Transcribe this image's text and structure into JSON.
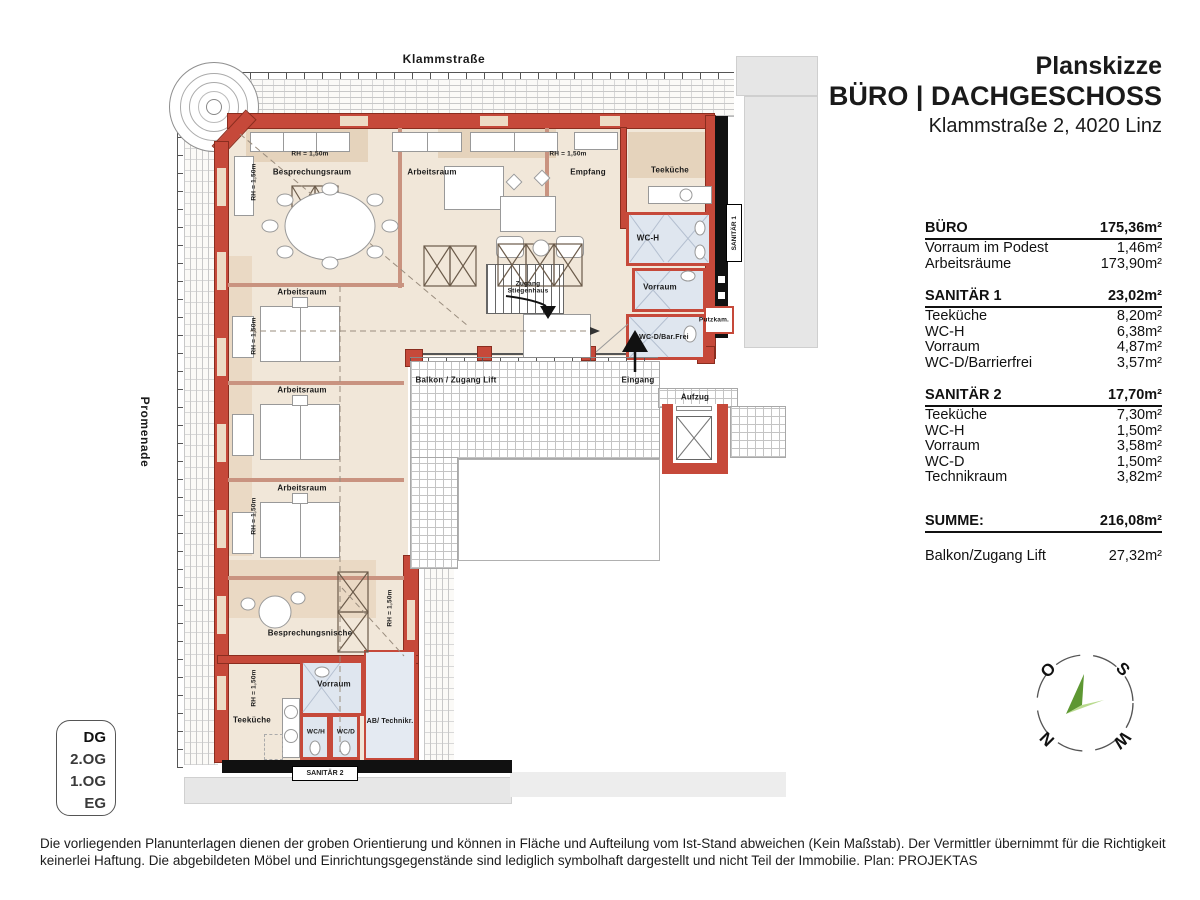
{
  "header": {
    "title": "Planskizze",
    "subtitle": "BÜRO | DACHGESCHOSS",
    "address": "Klammstraße 2, 4020 Linz"
  },
  "area_table": {
    "rows": [
      {
        "type": "header",
        "label": "BÜRO",
        "value": "175,36m²"
      },
      {
        "type": "item",
        "label": "Vorraum im Podest",
        "value": "1,46m²"
      },
      {
        "type": "item",
        "label": "Arbeitsräume",
        "value": "173,90m²"
      },
      {
        "type": "gap"
      },
      {
        "type": "header",
        "label": "SANITÄR 1",
        "value": "23,02m²"
      },
      {
        "type": "item",
        "label": "Teeküche",
        "value": "8,20m²"
      },
      {
        "type": "item",
        "label": "WC-H",
        "value": "6,38m²"
      },
      {
        "type": "item",
        "label": "Vorraum",
        "value": "4,87m²"
      },
      {
        "type": "item",
        "label": "WC-D/Barrierfrei",
        "value": "3,57m²"
      },
      {
        "type": "gap"
      },
      {
        "type": "header",
        "label": "SANITÄR 2",
        "value": "17,70m²"
      },
      {
        "type": "item",
        "label": "Teeküche",
        "value": "7,30m²"
      },
      {
        "type": "item",
        "label": "WC-H",
        "value": "1,50m²"
      },
      {
        "type": "item",
        "label": "Vorraum",
        "value": "3,58m²"
      },
      {
        "type": "item",
        "label": "WC-D",
        "value": "1,50m²"
      },
      {
        "type": "item",
        "label": "Technikraum",
        "value": "3,82m²"
      },
      {
        "type": "biggap"
      },
      {
        "type": "header",
        "label": "SUMME:",
        "value": "216,08m²"
      },
      {
        "type": "gapsmall"
      },
      {
        "type": "item",
        "label": "Balkon/Zugang Lift",
        "value": "27,32m²"
      }
    ]
  },
  "floor_selector": {
    "floors": [
      {
        "label": "DG",
        "active": true
      },
      {
        "label": "2.OG"
      },
      {
        "label": "1.OG"
      },
      {
        "label": "EG"
      }
    ]
  },
  "compass": {
    "o": "O",
    "s": "S",
    "n": "N",
    "w": "W"
  },
  "plan": {
    "labels": {
      "street": "Klammstraße",
      "promenade": "Promenade",
      "besprechungsraum": "Besprechungsraum",
      "arbeitsraum": "Arbeitsraum",
      "rh": "RH = 1,50m",
      "empfang": "Empfang",
      "teekueche": "Teeküche",
      "wch": "WC-H",
      "vorraum": "Vorraum",
      "putzkam": "Putzkam.",
      "wcd_barrierefrei": "WC-D/Bar.Frei",
      "zugang_stiegenhaus": "Zugang\nStiegenhaus",
      "balkon": "Balkon / Zugang Lift",
      "eingang": "Eingang",
      "aufzug": "Aufzug",
      "sanitaer1": "SANITÄR 1",
      "sanitaer2": "SANITÄR 2",
      "besprechungsnische": "Besprechungsnische",
      "wch2": "WC/H",
      "wcd2": "WC/D",
      "ab_technikraum": "AB/ Technikr."
    }
  },
  "disclaimer": {
    "line1": "Die vorliegenden Planunterlagen dienen der groben Orientierung und können in Fläche und Aufteilung vom Ist-Stand abweichen (Kein Maßstab). Der Vermittler übernimmt für die Richtigkeit",
    "line2": "keinerlei Haftung. Die abgebildeten Möbel und Einrichtungsgegenstände sind lediglich symbolhaft dargestellt und nicht Teil der Immobilie. Plan: PROJEKTAS"
  },
  "colors": {
    "wall_red": "#c6493a",
    "floor_beige": "#f1e7d9",
    "wet_room_blue": "#dfe6ef",
    "highlight_green": "#a7cf5d",
    "compass_green_dark": "#5d9732",
    "compass_green_light": "#b9db8f",
    "band_black": "#111111",
    "neighbor_gray": "#e6e6e6"
  }
}
